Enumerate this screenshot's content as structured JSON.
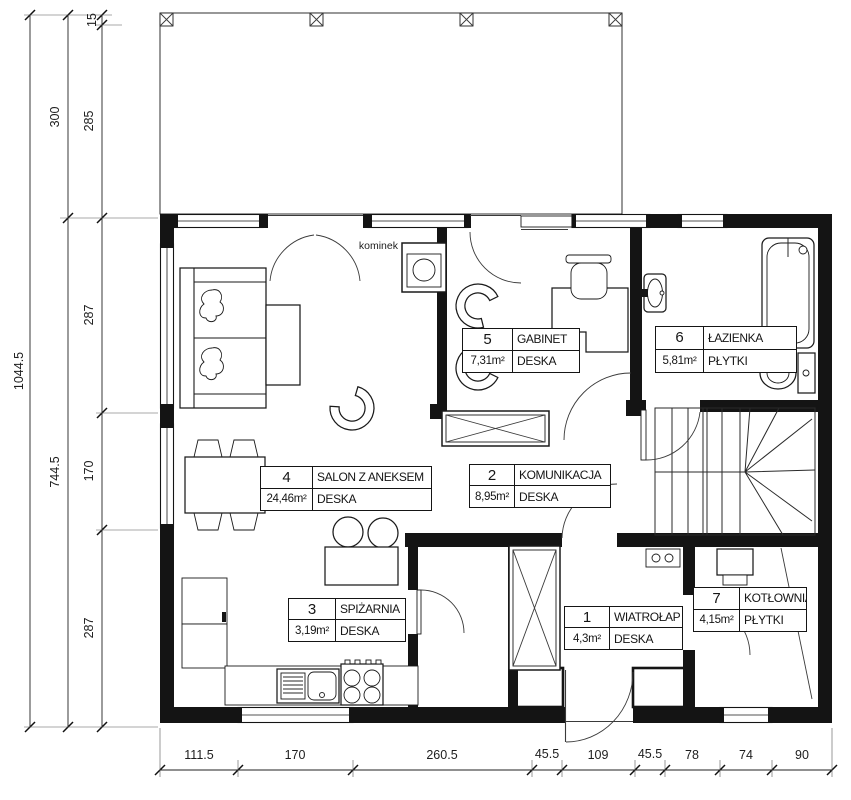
{
  "drawing": {
    "type": "architectural floor plan (ground floor)"
  },
  "rooms": [
    {
      "number": "1",
      "name": "WIATROŁAP",
      "area": "4,3m²",
      "floor": "DESKA"
    },
    {
      "number": "2",
      "name": "KOMUNIKACJA",
      "area": "8,95m²",
      "floor": "DESKA"
    },
    {
      "number": "3",
      "name": "SPIŻARNIA",
      "area": "3,19m²",
      "floor": "DESKA"
    },
    {
      "number": "4",
      "name": "SALON Z ANEKSEM",
      "area": "24,46m²",
      "floor": "DESKA"
    },
    {
      "number": "5",
      "name": "GABINET",
      "area": "7,31m²",
      "floor": "DESKA"
    },
    {
      "number": "6",
      "name": "ŁAZIENKA",
      "area": "5,81m²",
      "floor": "PŁYTKI"
    },
    {
      "number": "7",
      "name": "KOTŁOWNIA",
      "area": "4,15m²",
      "floor": "PŁYTKI"
    }
  ],
  "annotations": {
    "fireplace": "kominek"
  },
  "dimensions": {
    "left_total": "1044.5",
    "left_mid": [
      "300",
      "744.5"
    ],
    "left_inner": [
      "15",
      "285",
      "287",
      "170",
      "287"
    ],
    "bottom": [
      "111.5",
      "170",
      "260.5",
      "45.5",
      "109",
      "45.5",
      "78",
      "74",
      "90"
    ]
  },
  "colors": {
    "line": "#1a1a1a",
    "background": "#ffffff"
  }
}
